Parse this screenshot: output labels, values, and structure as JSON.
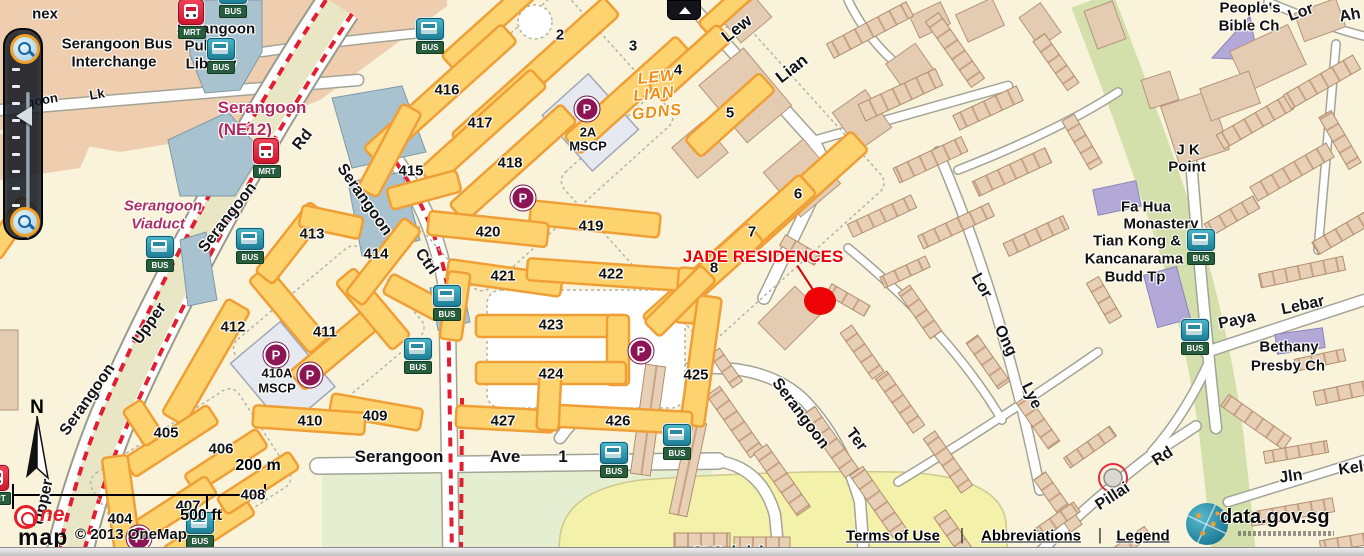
{
  "map": {
    "labels": [
      {
        "t": "nex",
        "x": 45,
        "y": 14,
        "c": "poi"
      },
      {
        "t": "Serangoon Bus",
        "x": 117,
        "y": 44,
        "c": "poi"
      },
      {
        "t": "Interchange",
        "x": 114,
        "y": 62,
        "c": "poi"
      },
      {
        "t": "Serangoon",
        "x": 216,
        "y": 29,
        "c": "poi"
      },
      {
        "t": "Public",
        "x": 207,
        "y": 46,
        "c": "poi"
      },
      {
        "t": "Library",
        "x": 211,
        "y": 64,
        "c": "poi"
      },
      {
        "t": "Serangoon",
        "x": 262,
        "y": 108,
        "c": "mrtname"
      },
      {
        "t": "(NE12)",
        "x": 245,
        "y": 130,
        "c": "mrtname"
      },
      {
        "t": "Serangoon",
        "x": 163,
        "y": 206,
        "c": "viaduct"
      },
      {
        "t": "Viaduct",
        "x": 158,
        "y": 224,
        "c": "viaduct"
      },
      {
        "t": "LEW",
        "x": 657,
        "y": 78,
        "c": "gdns",
        "r": -6
      },
      {
        "t": "LIAN",
        "x": 654,
        "y": 95,
        "c": "gdns",
        "r": -6
      },
      {
        "t": "GDNS",
        "x": 657,
        "y": 113,
        "c": "gdns",
        "r": -6
      },
      {
        "t": "2A",
        "x": 588,
        "y": 132,
        "c": "poi2"
      },
      {
        "t": "MSCP",
        "x": 588,
        "y": 146,
        "c": "poi2"
      },
      {
        "t": "410A",
        "x": 277,
        "y": 373,
        "c": "poi2"
      },
      {
        "t": "MSCP",
        "x": 277,
        "y": 388,
        "c": "poi2"
      },
      {
        "t": "People's",
        "x": 1250,
        "y": 8,
        "c": "poi"
      },
      {
        "t": "Bible Ch",
        "x": 1249,
        "y": 26,
        "c": "poi"
      },
      {
        "t": "J K",
        "x": 1188,
        "y": 150,
        "c": "poi"
      },
      {
        "t": "Point",
        "x": 1187,
        "y": 167,
        "c": "poi"
      },
      {
        "t": "Fa Hua",
        "x": 1146,
        "y": 207,
        "c": "poi"
      },
      {
        "t": "Monastery",
        "x": 1161,
        "y": 224,
        "c": "poi"
      },
      {
        "t": "Tian Kong &",
        "x": 1137,
        "y": 241,
        "c": "poi"
      },
      {
        "t": "Kancanarama",
        "x": 1134,
        "y": 259,
        "c": "poi"
      },
      {
        "t": "Budd Tp",
        "x": 1135,
        "y": 277,
        "c": "poi"
      },
      {
        "t": "Bethany",
        "x": 1289,
        "y": 347,
        "c": "poi"
      },
      {
        "t": "Presby Ch",
        "x": 1288,
        "y": 366,
        "c": "poi"
      },
      {
        "t": "St Gabriel",
        "x": 728,
        "y": 552,
        "c": "poi"
      },
      {
        "t": "goon",
        "x": 42,
        "y": 100,
        "c": "roadsm",
        "r": -10
      },
      {
        "t": "Lk",
        "x": 97,
        "y": 94,
        "c": "roadsm",
        "r": -10
      },
      {
        "t": "Serangoon",
        "x": 228,
        "y": 218,
        "c": "road",
        "r": -52
      },
      {
        "t": "Rd",
        "x": 303,
        "y": 140,
        "c": "road",
        "r": -52
      },
      {
        "t": "Upper",
        "x": 150,
        "y": 324,
        "c": "road",
        "r": -55
      },
      {
        "t": "Serangoon",
        "x": 88,
        "y": 400,
        "c": "road",
        "r": -55
      },
      {
        "t": "Upper",
        "x": 44,
        "y": 502,
        "c": "road",
        "r": -78
      },
      {
        "t": "Serangoon",
        "x": 364,
        "y": 200,
        "c": "road",
        "r": 55
      },
      {
        "t": "Ctrl",
        "x": 426,
        "y": 262,
        "c": "road",
        "r": 55
      },
      {
        "t": "Serangoon",
        "x": 399,
        "y": 457,
        "c": "roadh"
      },
      {
        "t": "Ave",
        "x": 505,
        "y": 457,
        "c": "roadh"
      },
      {
        "t": "1",
        "x": 563,
        "y": 457,
        "c": "roadh"
      },
      {
        "t": "Lew",
        "x": 737,
        "y": 29,
        "c": "roadh",
        "r": -38
      },
      {
        "t": "Lian",
        "x": 792,
        "y": 69,
        "c": "roadh",
        "r": -38
      },
      {
        "t": "Serangoon",
        "x": 800,
        "y": 414,
        "c": "road",
        "r": 53
      },
      {
        "t": "Ter",
        "x": 856,
        "y": 440,
        "c": "road",
        "r": 53
      },
      {
        "t": "Lor",
        "x": 981,
        "y": 286,
        "c": "road",
        "r": 60
      },
      {
        "t": "Ong",
        "x": 1005,
        "y": 341,
        "c": "road",
        "r": 64
      },
      {
        "t": "Lye",
        "x": 1031,
        "y": 396,
        "c": "road",
        "r": 64
      },
      {
        "t": "Pillai",
        "x": 1113,
        "y": 497,
        "c": "road",
        "r": -33
      },
      {
        "t": "Rd",
        "x": 1163,
        "y": 457,
        "c": "road",
        "r": -33
      },
      {
        "t": "Paya",
        "x": 1237,
        "y": 321,
        "c": "road",
        "r": -12
      },
      {
        "t": "Lebar",
        "x": 1303,
        "y": 306,
        "c": "road",
        "r": -12
      },
      {
        "t": "Jln",
        "x": 1291,
        "y": 477,
        "c": "road",
        "r": -8
      },
      {
        "t": "Kel",
        "x": 1351,
        "y": 469,
        "c": "road",
        "r": -8
      },
      {
        "t": "Lor",
        "x": 1301,
        "y": 13,
        "c": "road",
        "r": -20
      },
      {
        "t": "Ah",
        "x": 1350,
        "y": 16,
        "c": "road",
        "r": -10
      }
    ],
    "block_numbers": [
      {
        "t": "2",
        "x": 560,
        "y": 35
      },
      {
        "t": "3",
        "x": 633,
        "y": 46
      },
      {
        "t": "4",
        "x": 678,
        "y": 70
      },
      {
        "t": "5",
        "x": 730,
        "y": 113
      },
      {
        "t": "6",
        "x": 798,
        "y": 194
      },
      {
        "t": "7",
        "x": 752,
        "y": 232
      },
      {
        "t": "8",
        "x": 714,
        "y": 268
      },
      {
        "t": "416",
        "x": 447,
        "y": 90
      },
      {
        "t": "417",
        "x": 480,
        "y": 123
      },
      {
        "t": "418",
        "x": 510,
        "y": 163
      },
      {
        "t": "415",
        "x": 411,
        "y": 171
      },
      {
        "t": "419",
        "x": 591,
        "y": 226
      },
      {
        "t": "420",
        "x": 488,
        "y": 232
      },
      {
        "t": "421",
        "x": 503,
        "y": 276
      },
      {
        "t": "422",
        "x": 611,
        "y": 274
      },
      {
        "t": "423",
        "x": 551,
        "y": 325
      },
      {
        "t": "424",
        "x": 551,
        "y": 374
      },
      {
        "t": "425",
        "x": 696,
        "y": 375
      },
      {
        "t": "426",
        "x": 618,
        "y": 421
      },
      {
        "t": "427",
        "x": 503,
        "y": 421
      },
      {
        "t": "409",
        "x": 375,
        "y": 416
      },
      {
        "t": "410",
        "x": 310,
        "y": 421
      },
      {
        "t": "411",
        "x": 325,
        "y": 332
      },
      {
        "t": "412",
        "x": 233,
        "y": 327
      },
      {
        "t": "413",
        "x": 312,
        "y": 234
      },
      {
        "t": "414",
        "x": 376,
        "y": 254
      },
      {
        "t": "405",
        "x": 166,
        "y": 433
      },
      {
        "t": "406",
        "x": 221,
        "y": 449
      },
      {
        "t": "407",
        "x": 188,
        "y": 506
      },
      {
        "t": "404",
        "x": 120,
        "y": 519
      },
      {
        "t": "408",
        "x": 253,
        "y": 495
      }
    ],
    "bus_tag": "BUS",
    "mrt_tag": "MRT",
    "parking_letter": "P",
    "bus_stops": [
      {
        "x": 233,
        "y": -6
      },
      {
        "x": 221,
        "y": 50
      },
      {
        "x": 430,
        "y": 30
      },
      {
        "x": 250,
        "y": 240
      },
      {
        "x": 160,
        "y": 248
      },
      {
        "x": 447,
        "y": 297
      },
      {
        "x": 418,
        "y": 350
      },
      {
        "x": 614,
        "y": 454
      },
      {
        "x": 677,
        "y": 436
      },
      {
        "x": 1201,
        "y": 241
      },
      {
        "x": 1195,
        "y": 331
      },
      {
        "x": 200,
        "y": 524
      }
    ],
    "mrt_stations": [
      {
        "x": 192,
        "y": 12
      },
      {
        "x": 267,
        "y": 151
      },
      {
        "x": -3,
        "y": 478
      }
    ],
    "parking": [
      {
        "x": 587,
        "y": 109
      },
      {
        "x": 523,
        "y": 198
      },
      {
        "x": 276,
        "y": 355
      },
      {
        "x": 310,
        "y": 375
      },
      {
        "x": 641,
        "y": 351
      },
      {
        "x": 139,
        "y": 538
      }
    ],
    "marker": {
      "label": "JADE RESIDENCES",
      "label_x": 763,
      "label_y": 257,
      "dot_x": 820,
      "dot_y": 301,
      "line_x": 806,
      "line_y": 279
    }
  },
  "north": {
    "label": "N"
  },
  "scalebar": {
    "metric": "200 m",
    "imperial": "500 ft"
  },
  "attribution": {
    "logo_ne": "ne",
    "logo_map": "map",
    "copyright": "© 2013 OneMap"
  },
  "footer": {
    "terms": "Terms of Use",
    "abbreviations": "Abbreviations",
    "legend": "Legend",
    "separator": "|"
  },
  "datagov": {
    "label": "data.gov.sg"
  }
}
